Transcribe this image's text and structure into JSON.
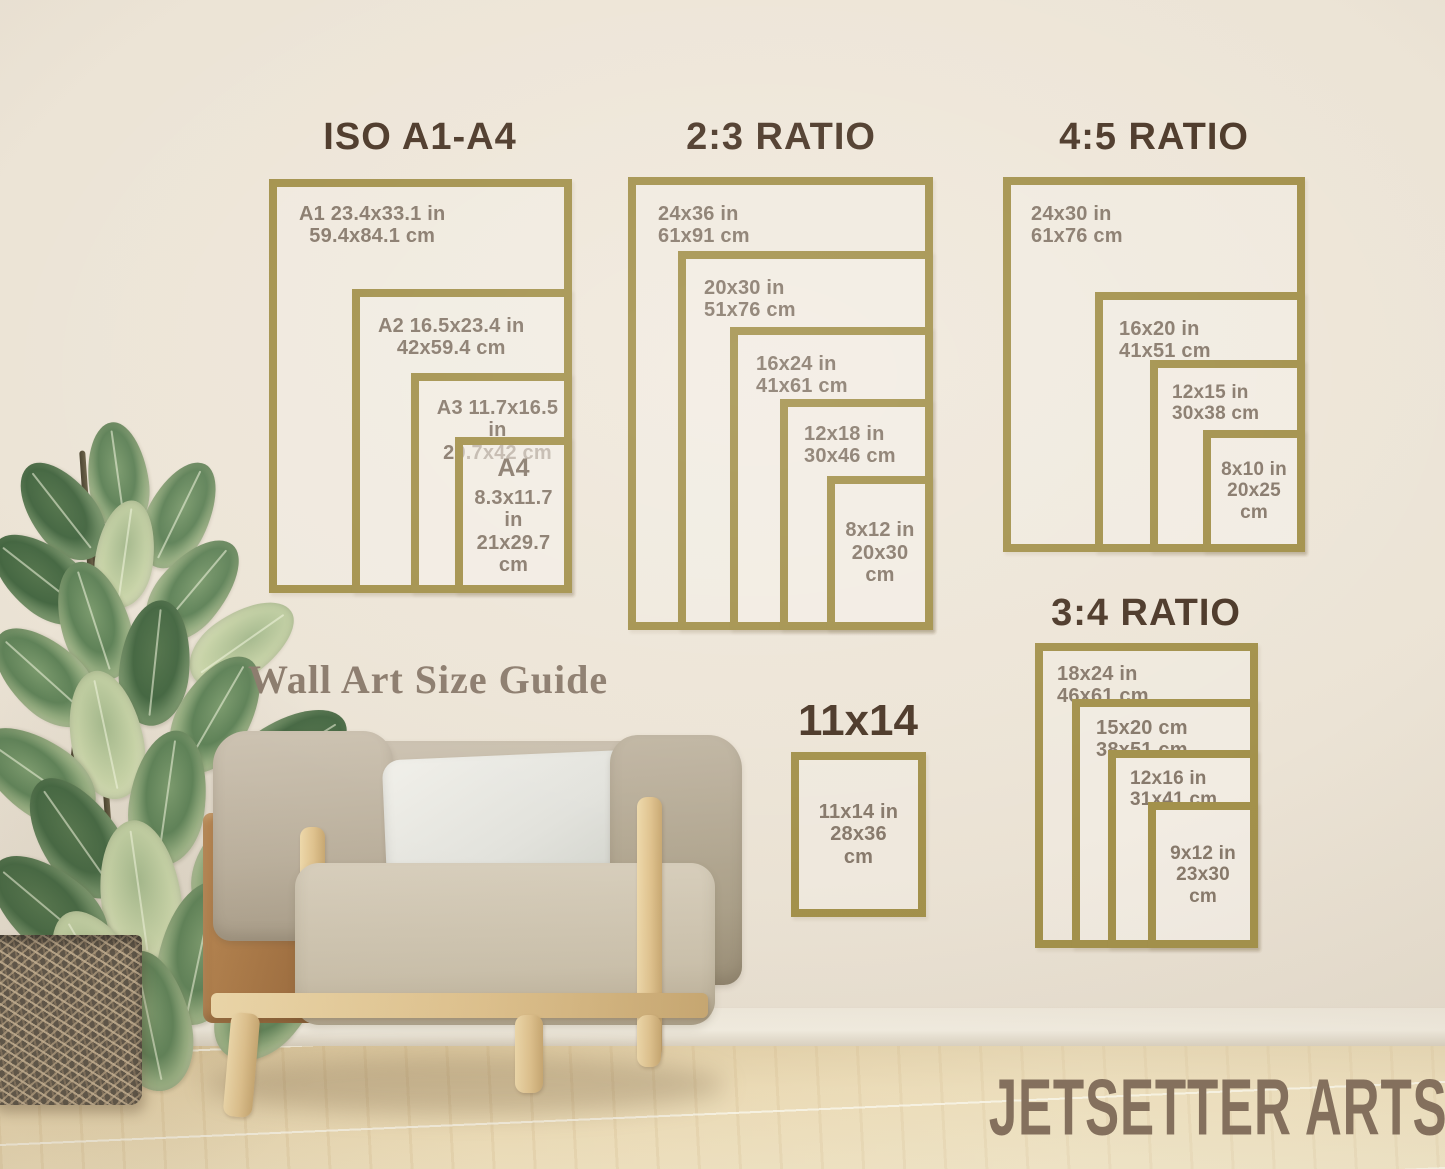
{
  "heading": {
    "text": "Wall Art Size Guide"
  },
  "brand": {
    "watermark": "JETSETTER ARTS"
  },
  "colors": {
    "frame_gold": "#a3914b",
    "title_brown": "#4a3626",
    "label_taupe": "#87796b"
  },
  "sections": {
    "iso": {
      "title": "ISO A1-A4",
      "frames": [
        {
          "l1": "A1 23.4x33.1 in",
          "l2": "59.4x84.1 cm"
        },
        {
          "l1": "A2 16.5x23.4 in",
          "l2": "42x59.4 cm"
        },
        {
          "l1": "A3 11.7x16.5 in",
          "l2": "29.7x42 cm"
        },
        {
          "l1": "A4",
          "l2": "8.3x11.7 in",
          "l3": "21x29.7",
          "l4": "cm"
        }
      ]
    },
    "ratio23": {
      "title": "2:3 RATIO",
      "frames": [
        {
          "l1": "24x36 in",
          "l2": "61x91 cm"
        },
        {
          "l1": "20x30 in",
          "l2": "51x76 cm"
        },
        {
          "l1": "16x24 in",
          "l2": "41x61 cm"
        },
        {
          "l1": "12x18 in",
          "l2": "30x46 cm"
        },
        {
          "l1": "8x12 in",
          "l2": "20x30",
          "l3": "cm"
        }
      ]
    },
    "ratio45": {
      "title": "4:5 RATIO",
      "frames": [
        {
          "l1": "24x30 in",
          "l2": "61x76 cm"
        },
        {
          "l1": "16x20 in",
          "l2": "41x51 cm"
        },
        {
          "l1": "12x15 in",
          "l2": "30x38 cm"
        },
        {
          "l1": "8x10 in",
          "l2": "20x25",
          "l3": "cm"
        }
      ]
    },
    "ratio34": {
      "title": "3:4 RATIO",
      "frames": [
        {
          "l1": "18x24 in",
          "l2": "46x61 cm"
        },
        {
          "l1": "15x20 cm",
          "l2": "38x51 cm"
        },
        {
          "l1": "12x16 in",
          "l2": "31x41 cm"
        },
        {
          "l1": "9x12 in",
          "l2": "23x30",
          "l3": "cm"
        }
      ]
    },
    "single1114": {
      "title": "11x14",
      "frames": [
        {
          "l1": "11x14 in",
          "l2": "28x36",
          "l3": "cm"
        }
      ]
    }
  }
}
